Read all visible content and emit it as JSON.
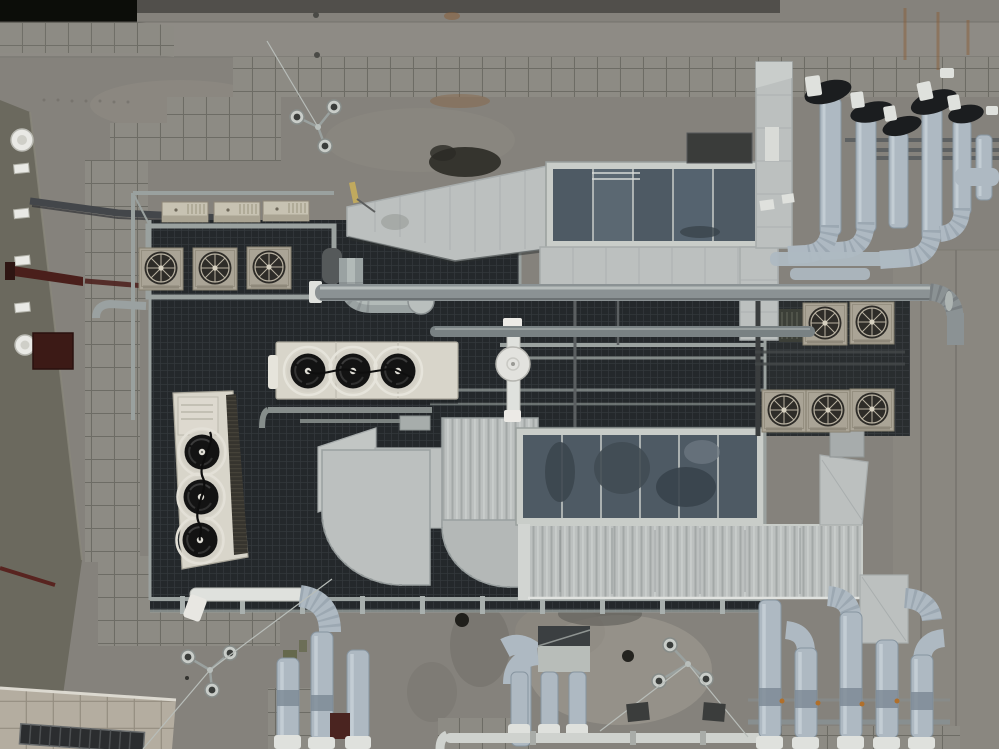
{
  "scene": {
    "description": "Aerial top-down drone photograph of a building rooftop crowded with HVAC equipment: air handling units with dark panel tops, galvanized sheet-metal ducts and elbows, clusters of insulated pipes with black fittings, fan condenser units, tiled walkways, a left facade wall with vents, and concrete with rust stains.",
    "view": "top-down",
    "lighting": "overcast, flat dusk light"
  },
  "palette": {
    "concrete": "#85827c",
    "concrete_light": "#98948b",
    "concrete_dark": "#6e6b65",
    "concrete_top": "#8e8b85",
    "void_black": "#0c0d09",
    "top_strip": "#514f4b",
    "tile_fill": "#8d8b84",
    "tile_line": "#67665f",
    "tile_cream": "#b4ada0",
    "tile_cream_line": "#948d80",
    "wall_olive": "#6b695e",
    "wall_edge": "#8a887c",
    "maroon": "#4a1f1b",
    "maroon_dark": "#2e1512",
    "door_red": "#3c1a16",
    "white_fixture": "#e9e9e5",
    "mesh_dark": "#24282b",
    "mesh_line": "#32373b",
    "steel_frame": "#9aa19f",
    "steel_dark": "#54585a",
    "duct_light": "#bcc0bf",
    "duct_mid": "#a7acac",
    "duct_seam": "#8f9595",
    "duct_corrug": "#a3a8a7",
    "ahu_frame": "#c9cdc9",
    "ahu_panel": "#4e5a64",
    "ahu_panel_lt": "#5f6b75",
    "cream_unit": "#d8d5ca",
    "cream_shadow": "#b2afa4",
    "fan_black": "#131313",
    "fan_rim": "#d3d0c6",
    "coil_dark": "#36342e",
    "ac_face": "#aaa496",
    "ac_grille": "#2e2c28",
    "ac_spoke": "#b9b2a2",
    "beige_box": "#c7c2b2",
    "pipe_insul": "#aeb9c2",
    "pipe_insul_lt": "#c9d3d9",
    "pipe_insul_dk": "#8795a0",
    "pipe_black": "#1b1d1f",
    "pipe_white": "#dfe1dd",
    "pipe_steel": "#8b9294",
    "pipe_steel_lt": "#c2c8c6",
    "rust": "#8a5c33",
    "stain_dark": "#2c2b26",
    "stain_light": "#a39e93",
    "moss": "#5c6140",
    "window_dark": "#2b2d2f",
    "yellow_detail": "#c0a95e",
    "valve_orange": "#b06f2a"
  },
  "objects": [
    {
      "name": "left-facade-wall",
      "label": "Olive-gray facade wall seen obliquely",
      "approx_bbox": [
        0,
        100,
        82,
        612
      ]
    },
    {
      "name": "wall-vents",
      "label": "White rectangular wall vents",
      "count": 4,
      "approx_bbox": [
        14,
        163,
        16,
        152
      ]
    },
    {
      "name": "wall-lamps",
      "label": "Round white wall lamps",
      "count": 2,
      "approx_bbox": [
        11,
        129,
        25,
        227
      ]
    },
    {
      "name": "maroon-beam",
      "label": "Dark red beam on wall",
      "approx_bbox": [
        7,
        263,
        211,
        30
      ]
    },
    {
      "name": "maroon-door",
      "label": "Dark red door/hatch",
      "approx_bbox": [
        33,
        333,
        40,
        36
      ]
    },
    {
      "name": "parapet-tiles",
      "label": "Tiled parapet coping top-left",
      "approx_bbox": [
        0,
        22,
        174,
        35
      ]
    },
    {
      "name": "tiled-walkways",
      "label": "Gray paver tile walkways",
      "count": 9,
      "approx_bbox": [
        85,
        57,
        914,
        690
      ]
    },
    {
      "name": "equipment-platform",
      "label": "Dark mesh equipment platform with galvanized frame",
      "approx_bbox": [
        150,
        218,
        615,
        394
      ]
    },
    {
      "name": "beige-vent-boxes",
      "label": "Beige louvered vent boxes",
      "count": 3,
      "approx_bbox": [
        162,
        201,
        146,
        21
      ]
    },
    {
      "name": "ac-condensers-top-left",
      "label": "Fan condenser units, top-left row",
      "count": 3,
      "approx_bbox": [
        139,
        247,
        154,
        42
      ]
    },
    {
      "name": "ac-condensers-right-upper",
      "label": "Fan condenser units, right upper row",
      "count": 2,
      "approx_bbox": [
        803,
        302,
        91,
        43
      ]
    },
    {
      "name": "ac-condensers-right-lower",
      "label": "Fan condenser units, right lower row",
      "count": 3,
      "approx_bbox": [
        762,
        389,
        132,
        39
      ]
    },
    {
      "name": "horizontal-fan-unit",
      "label": "Cream dry-cooler with 3 black fans, horizontal",
      "approx_bbox": [
        276,
        342,
        182,
        57
      ]
    },
    {
      "name": "vertical-fan-unit",
      "label": "Cream chiller with 3 black fans and dark coil, vertical",
      "approx_bbox": [
        173,
        391,
        75,
        178
      ]
    },
    {
      "name": "round-silencer",
      "label": "White round inline silencer on white pipe",
      "approx_bbox": [
        496,
        318,
        34,
        104
      ]
    },
    {
      "name": "ahu-upper",
      "label": "Upper air handling unit with dark blue-gray panel top",
      "approx_bbox": [
        546,
        162,
        216,
        86
      ]
    },
    {
      "name": "ahu-lower",
      "label": "Lower air handling unit with dark panel top",
      "approx_bbox": [
        516,
        428,
        248,
        97
      ]
    },
    {
      "name": "main-supply-duct",
      "label": "Tapered galvanized supply duct",
      "approx_bbox": [
        347,
        165,
        205,
        97
      ]
    },
    {
      "name": "corrugated-duct-band",
      "label": "Long corrugated duct band",
      "approx_bbox": [
        528,
        525,
        334,
        73
      ]
    },
    {
      "name": "duct-elbows-large",
      "label": "Large quarter-round duct elbows",
      "count": 2,
      "approx_bbox": [
        318,
        428,
        220,
        159
      ]
    },
    {
      "name": "riser-duct",
      "label": "Vertical riser duct top-right",
      "approx_bbox": [
        756,
        62,
        36,
        186
      ]
    },
    {
      "name": "pipe-cluster-top-right",
      "label": "Insulated pipes with black elbow fittings",
      "count": 6,
      "approx_bbox": [
        800,
        62,
        199,
        215
      ]
    },
    {
      "name": "long-horizontal-pipe",
      "label": "Long galvanized pipe run with right-hand bend",
      "approx_bbox": [
        309,
        281,
        655,
        70
      ]
    },
    {
      "name": "pipe-cluster-bottom-center",
      "label": "Insulated pipe manifolds bottom-center",
      "count": 2,
      "approx_bbox": [
        188,
        583,
        402,
        166
      ]
    },
    {
      "name": "pipe-cluster-bottom-right",
      "label": "Insulated vertical pipes with caps, bottom-right",
      "count": 5,
      "approx_bbox": [
        748,
        575,
        202,
        174
      ]
    },
    {
      "name": "guy-wire-tripods",
      "label": "Tripod guy-wire anchor mounts",
      "count": 3,
      "approx_bbox": [
        188,
        100,
        560,
        595
      ]
    },
    {
      "name": "lower-roof",
      "label": "Cream tiled lower roof with dark windows, bottom-left",
      "approx_bbox": [
        0,
        688,
        176,
        61
      ]
    },
    {
      "name": "rust-stains",
      "label": "Rust streaks on upper concrete",
      "approx_bbox": [
        430,
        8,
        560,
        100
      ]
    }
  ]
}
